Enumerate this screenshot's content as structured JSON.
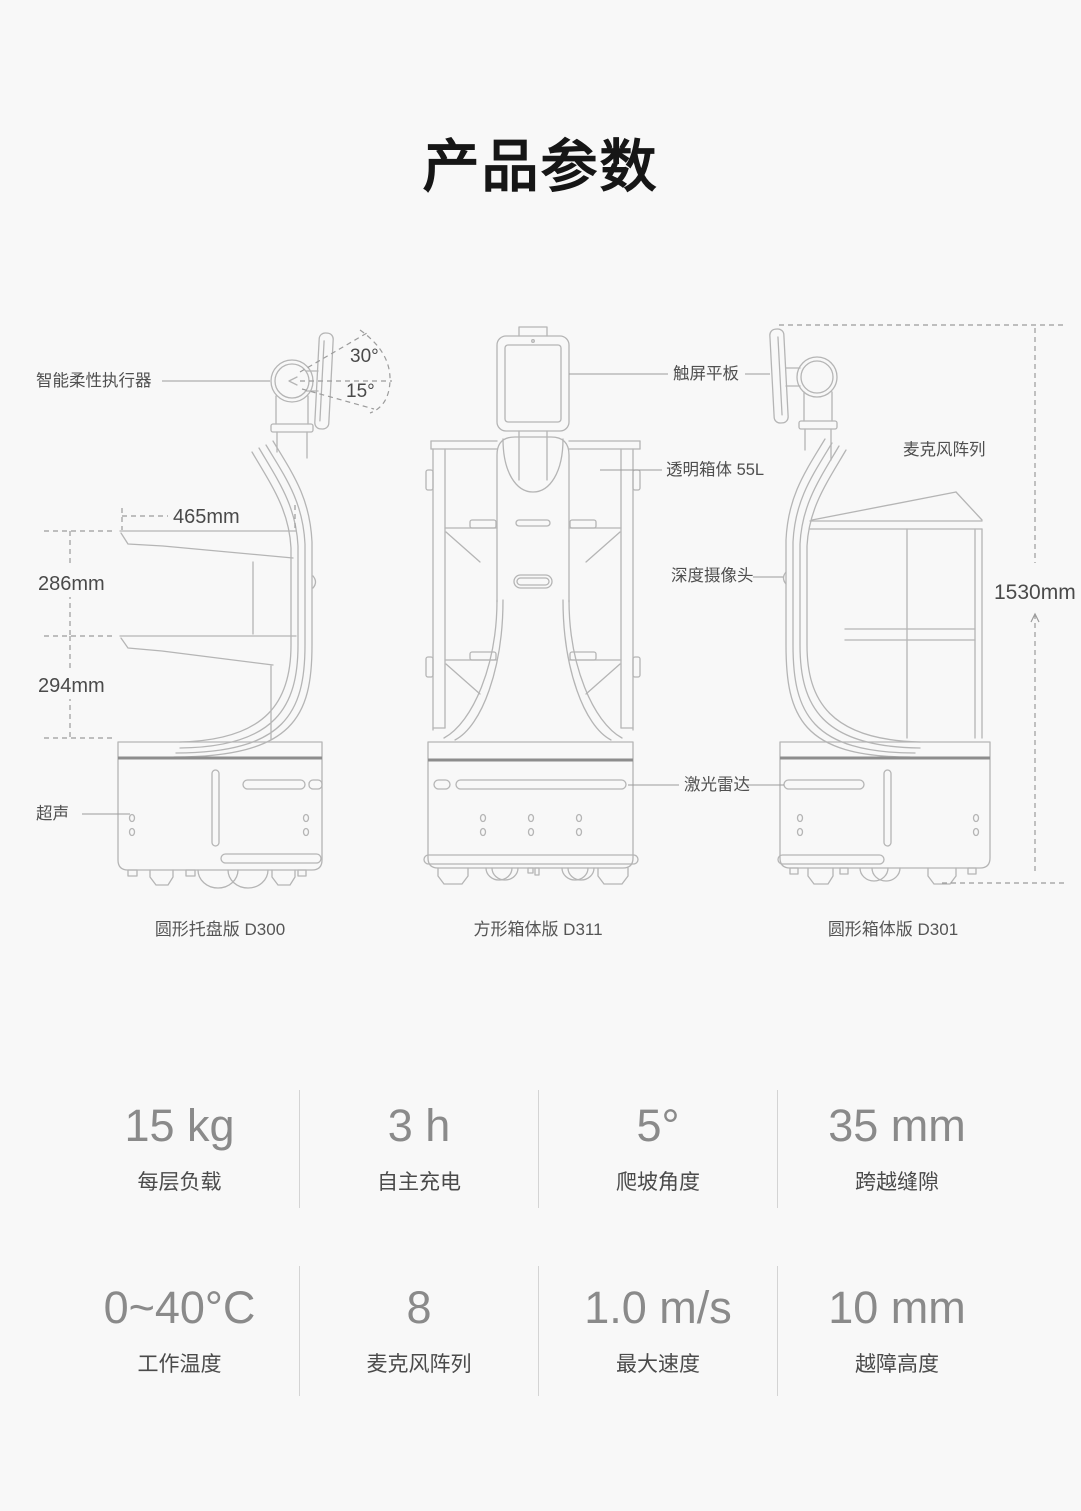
{
  "page": {
    "title": "产品参数"
  },
  "diagram": {
    "annotations": {
      "actuator": "智能柔性执行器",
      "angle_30": "30°",
      "angle_15": "15°",
      "dim_465": "465mm",
      "dim_286": "286mm",
      "dim_294": "294mm",
      "ultrasound": "超声",
      "tablet": "触屏平板",
      "box_55l": "透明箱体 55L",
      "depth_camera": "深度摄像头",
      "lidar": "激光雷达",
      "mic_array": "麦克风阵列",
      "dim_1530": "1530mm"
    },
    "captions": {
      "d300": "圆形托盘版 D300",
      "d311": "方形箱体版 D311",
      "d301": "圆形箱体版 D301"
    }
  },
  "specs": {
    "rows": [
      {
        "cells": [
          {
            "value": "15 kg",
            "label": "每层负载"
          },
          {
            "value": "3 h",
            "label": "自主充电"
          },
          {
            "value": "5°",
            "label": "爬坡角度"
          },
          {
            "value": "35 mm",
            "label": "跨越缝隙"
          }
        ]
      },
      {
        "cells": [
          {
            "value": "0~40°C",
            "label": "工作温度"
          },
          {
            "value": "8",
            "label": "麦克风阵列"
          },
          {
            "value": "1.0 m/s",
            "label": "最大速度"
          },
          {
            "value": "10 mm",
            "label": "越障高度"
          }
        ]
      }
    ]
  }
}
